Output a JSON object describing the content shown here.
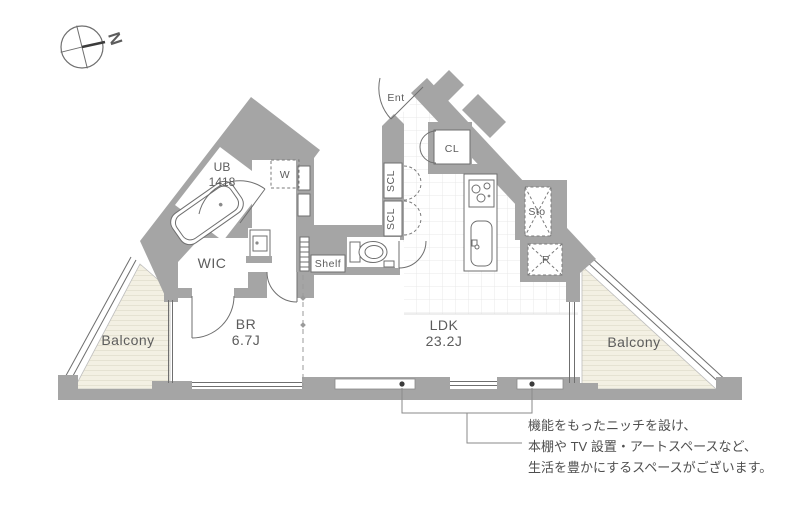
{
  "compass": {
    "north_label": "N"
  },
  "rooms": {
    "ub": {
      "name": "UB",
      "size": "1418"
    },
    "wic": {
      "name": "WIC"
    },
    "br": {
      "name": "BR",
      "size": "6.7J"
    },
    "ldk": {
      "name": "LDK",
      "size": "23.2J"
    },
    "balcony_left": {
      "name": "Balcony"
    },
    "balcony_right": {
      "name": "Balcony"
    },
    "ent": {
      "name": "Ent"
    },
    "cl": {
      "name": "CL"
    },
    "scl_upper": {
      "name": "SCL"
    },
    "scl_lower": {
      "name": "SCL"
    },
    "washer": {
      "name": "W"
    },
    "refrigerator": {
      "name": "R"
    },
    "storage": {
      "name": "Sto"
    },
    "shelf": {
      "name": "Shelf"
    }
  },
  "annotation": {
    "line1": "機能をもったニッチを設け、",
    "line2": "本棚や TV 設置・アートスペースなど、",
    "line3": "生活を豊かにするスペースがございます。"
  },
  "colors": {
    "wall": "#a5a5a5",
    "line": "#6f6f6f",
    "balcony_fill": "#f3f0e3",
    "balcony_stripe": "#e5e2d2",
    "tile_line": "#e8e8e8",
    "text": "#5c5c5c"
  }
}
